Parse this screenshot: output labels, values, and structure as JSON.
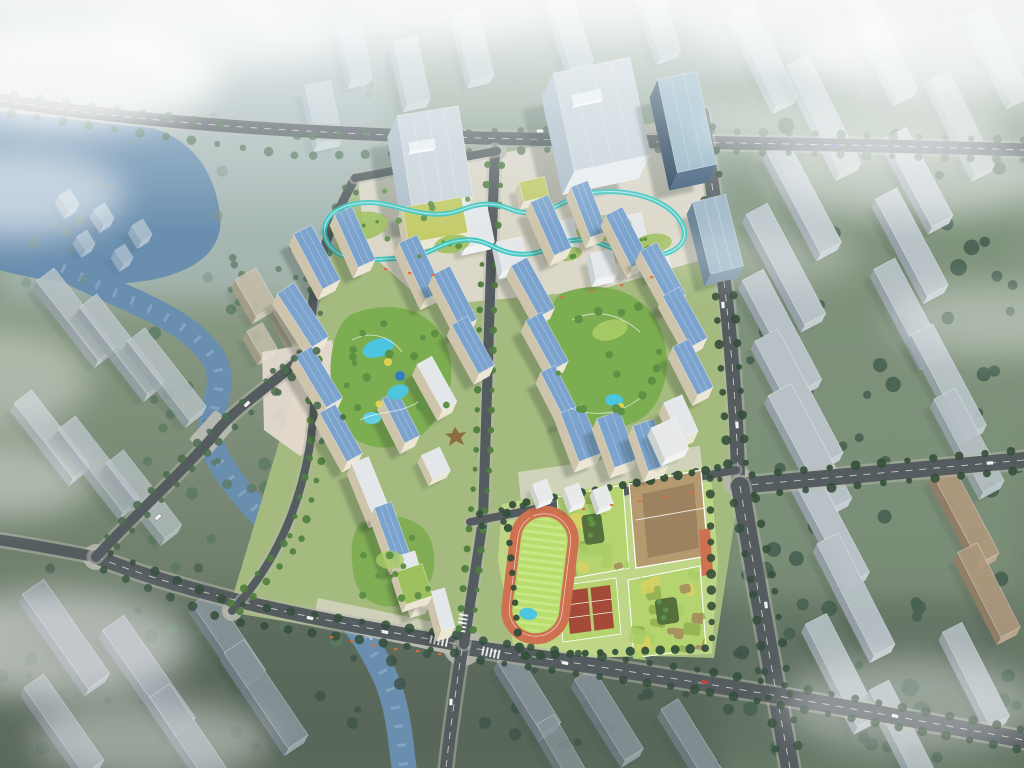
{
  "scene": {
    "kind": "aerial-architectural-rendering",
    "subject": "master-plan bird's-eye rendering of a mixed-use residential development",
    "features": [
      "office-towers-north",
      "skywalk-loop",
      "residential-cluster-west",
      "residential-cluster-east",
      "courtyard-pools",
      "school-campus-with-track",
      "river-west",
      "tree-lined-roads",
      "low-rise-context-buildings",
      "fog-clouds"
    ]
  },
  "palette": {
    "haze": "#e4edf2",
    "ground": "#7a8b70",
    "ground_top": "#9aab9a",
    "ground_dark": "#4e5d4a",
    "ground_tl": "#b7c7ce",
    "water": "#5b82a6",
    "water_light": "#8fb2cc",
    "road": "#555c60",
    "road_line": "#e8e8dc",
    "sidewalk": "#b5b7ac",
    "tree_dark": "#344f3b",
    "tree_mid": "#4a6b4d",
    "tree_bright": "#5d9146",
    "tree_hazy": "#87a08c",
    "ctx_roof": "#b4bdc1",
    "ctx_side": "#8d979d",
    "ctx_roof_light": "#ccd6db",
    "ctx_side_light": "#aab8c2",
    "ctx_dark_roof": "#7d888e",
    "ctx_dark_side": "#626d75",
    "ctx_brown": "#a98d6d",
    "ctx_brown_side": "#8a6f52",
    "site_green": "#a4ba7f",
    "school_ground": "#c0d687",
    "plaza": "#dcd8c9",
    "plaza_pink": "#e9ddd4",
    "court_green": "#7dad51",
    "court_light": "#a9cc67",
    "pool": "#4cc5de",
    "pool_deep": "#2f7fc2",
    "accent_yellow": "#e9d74e",
    "res_face": "#ece6d5",
    "res_side": "#cec4ab",
    "roof_blue": "#7ba3cd",
    "roof_white": "#e3e7e9",
    "office_face": "#e9eef2",
    "office_side": "#aebdc8",
    "office_roof": "#ccd5da",
    "navy_face": "#3c5a78",
    "navy_side": "#263f58",
    "navy_roof": "#93b4c4",
    "steel_face": "#7d98ac",
    "steel_side": "#5e7a90",
    "steel_roof": "#9db6c8",
    "skywalk": "#3cc5c1",
    "skywalk_hi": "#cdf3ef",
    "green_roof": "#9fc05e",
    "yellow_roof": "#c3cb69",
    "track": "#cd7150",
    "infield": "#b8dc6e",
    "infield_stripe": "#c8e787",
    "camo_base": "#b5d470",
    "camo_yellow": "#d9d063",
    "camo_tan": "#a5895c",
    "camo_olive": "#90ad50",
    "school_tan": "#b49a6e",
    "school_tan_dark": "#94795a",
    "school_red": "#a34b38",
    "orange": "#d9703e",
    "shadow": "#27352b",
    "white": "#ffffff",
    "car_red": "#c04438",
    "car_blue": "#3a6bb0",
    "bridge": "#b8bcb2",
    "weir": "#eef4f6",
    "sculpture": "#8a6b42"
  }
}
